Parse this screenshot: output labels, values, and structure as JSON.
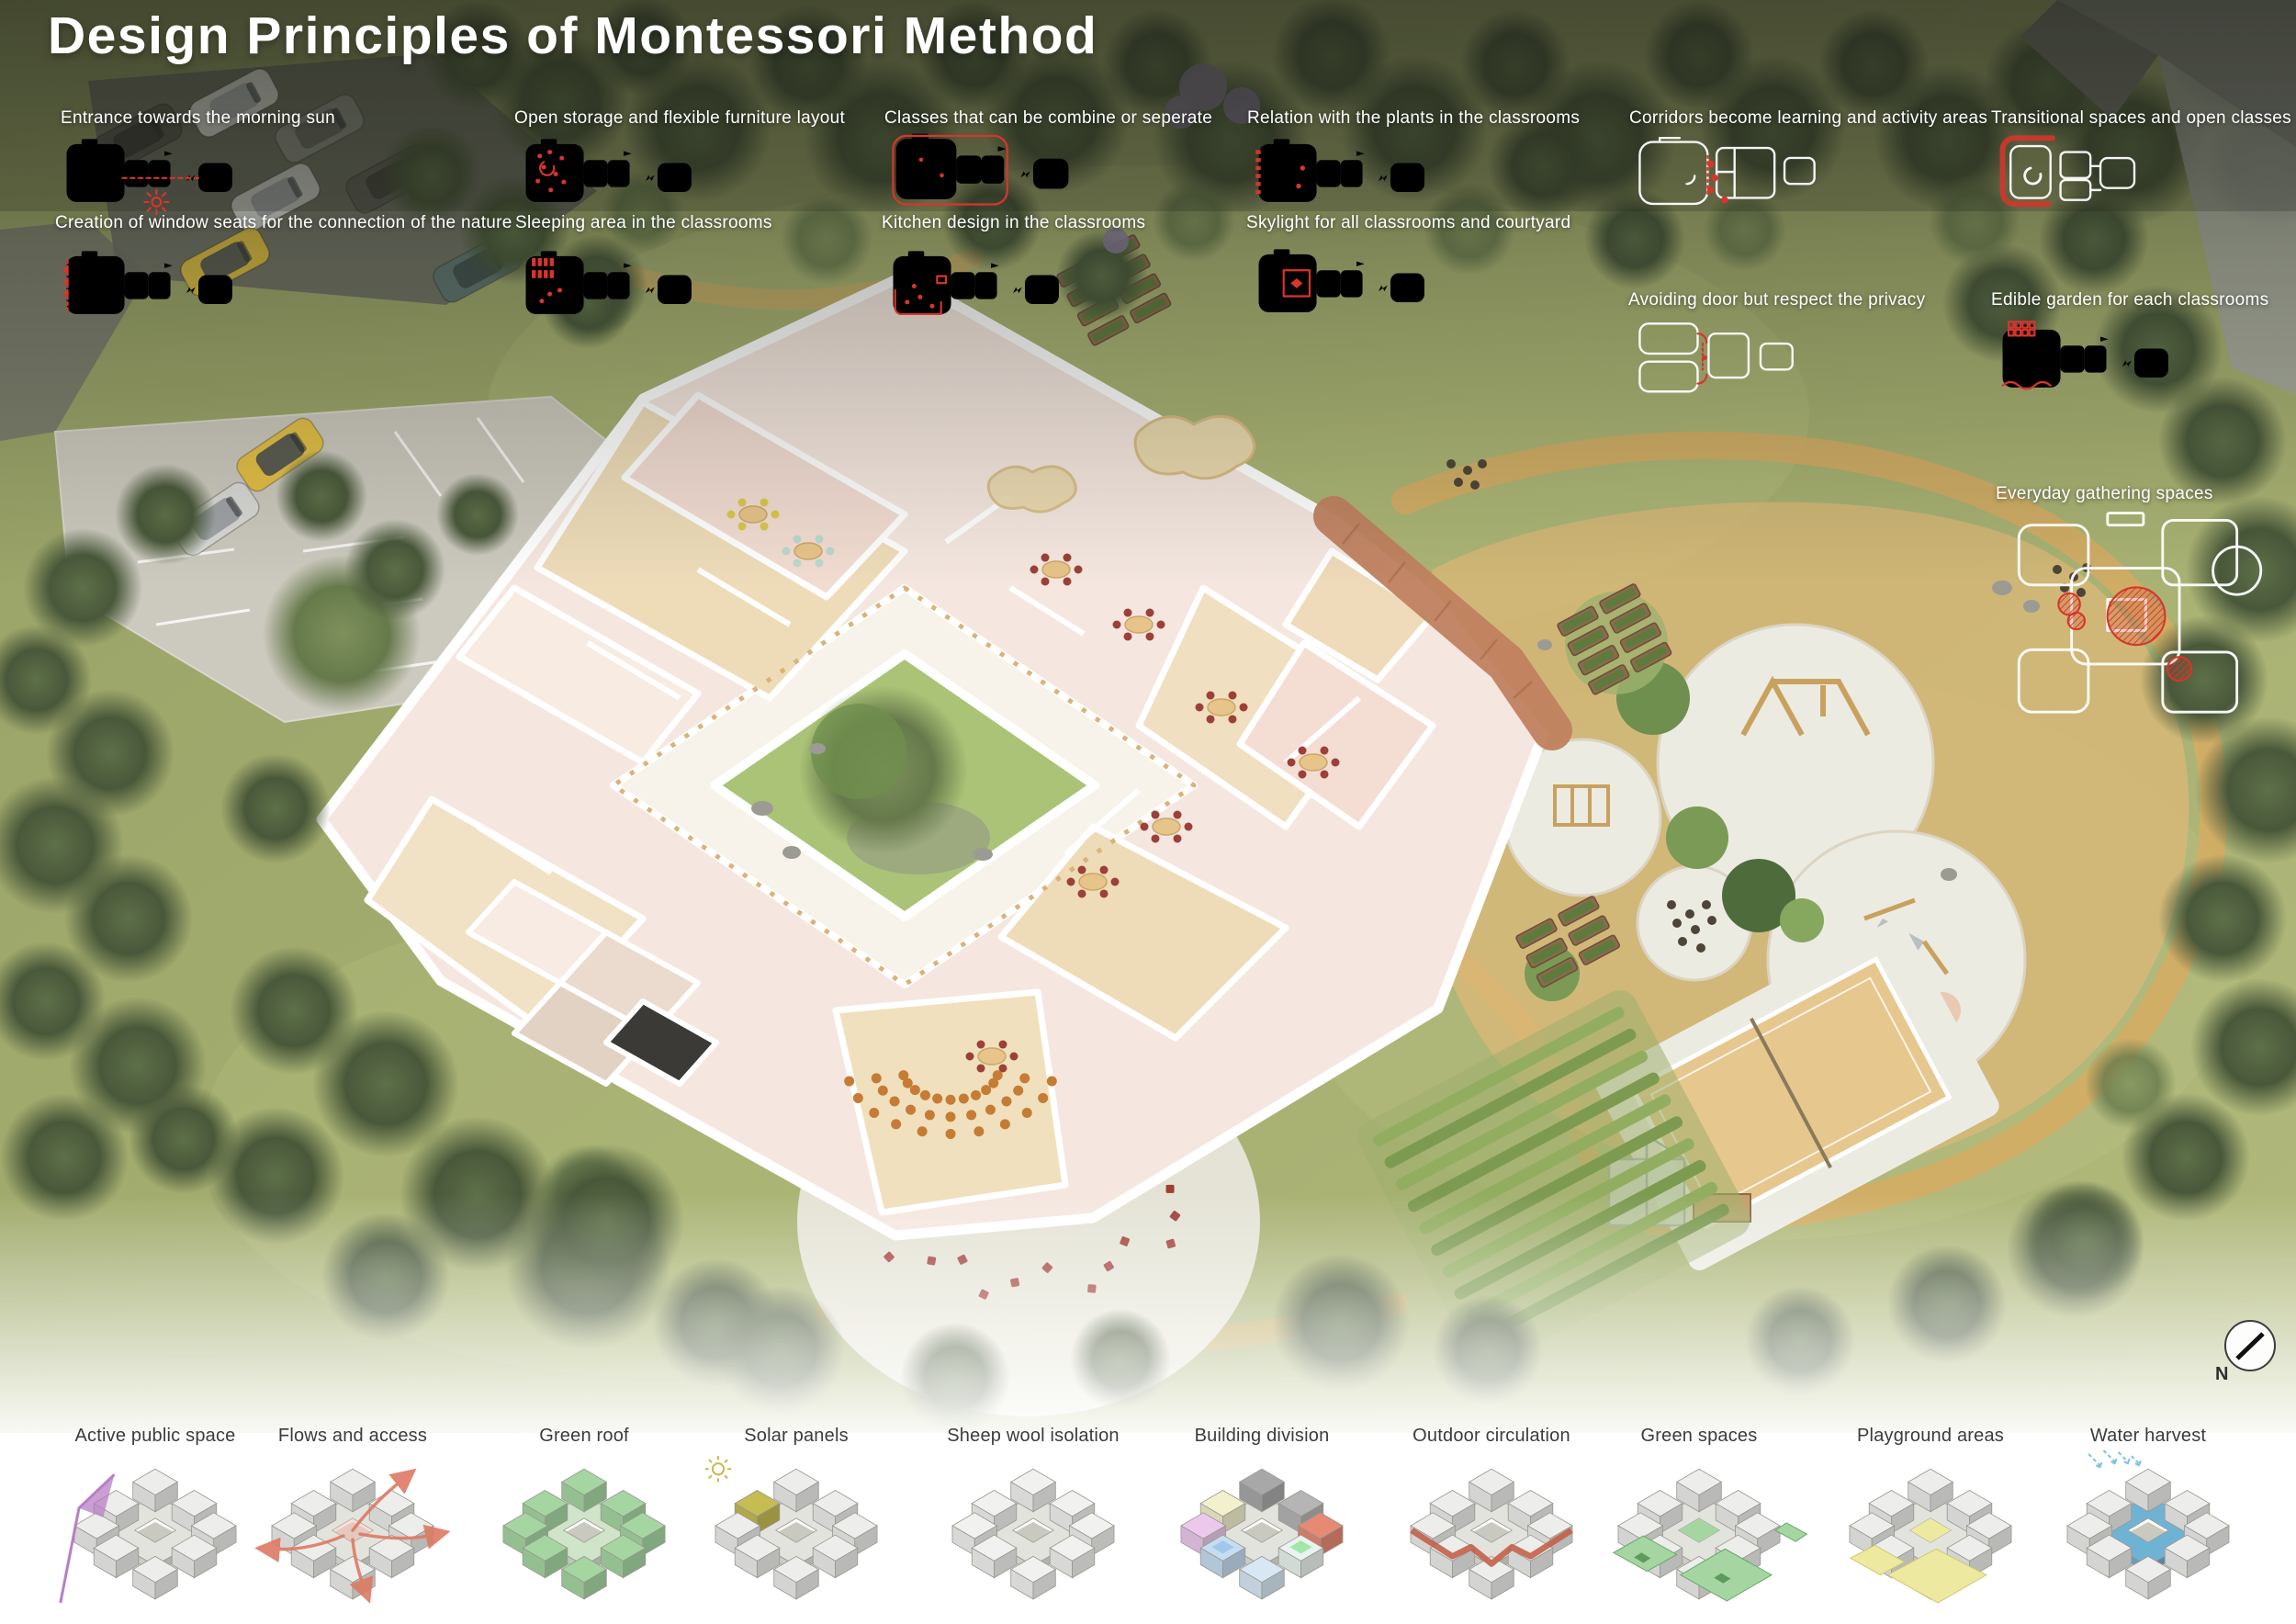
{
  "poster": {
    "title": "Design Principles of Montessori Method"
  },
  "principles": [
    {
      "label": "Entrance towards the morning sun"
    },
    {
      "label": "Creation of window seats for the connection of the nature"
    },
    {
      "label": "Open storage and flexible furniture layout"
    },
    {
      "label": "Sleeping area in the classrooms"
    },
    {
      "label": "Classes that can be combine or seperate"
    },
    {
      "label": "Kitchen design in the classrooms"
    },
    {
      "label": "Relation with the plants in the classrooms"
    },
    {
      "label": "Skylight for all classrooms and courtyard"
    },
    {
      "label": "Corridors become learning and activity areas"
    },
    {
      "label": "Avoiding door but respect the privacy"
    },
    {
      "label": "Transitional spaces and open classes"
    },
    {
      "label": "Edible garden for each classrooms"
    },
    {
      "label": "Everyday gathering spaces"
    }
  ],
  "strategies": [
    {
      "label": "Active public space",
      "accent": "#b77fc6"
    },
    {
      "label": "Flows and access",
      "accent": "#dd7a63"
    },
    {
      "label": "Green roof",
      "accent": "#a5d6a2"
    },
    {
      "label": "Solar panels",
      "accent": "#c5bc52"
    },
    {
      "label": "Sheep wool isolation",
      "accent": "#f1f1ef"
    },
    {
      "label": "Building division",
      "accent": "#d9cba9",
      "palette": [
        "#ecc9ec",
        "#f2f0cd",
        "#a8a8a8",
        "#b5b5b5",
        "#e78a74",
        "#eaf3ef",
        "#d7e8f4",
        "#c6ddf0",
        "#9fc8ec",
        "#9fe8a8"
      ]
    },
    {
      "label": "Outdoor circulation",
      "accent": "#c2604a"
    },
    {
      "label": "Green spaces",
      "accent": "#a5d6a2"
    },
    {
      "label": "Playground areas",
      "accent": "#eee9a0"
    },
    {
      "label": "Water harvest",
      "accent": "#6fb3d4"
    }
  ],
  "compass": {
    "label": "N"
  },
  "colors": {
    "plan_outline": "#ffffff",
    "plan_accent_red": "#d8352b",
    "building_pink": "#f5e7e0",
    "wood_floor": "#eedcb9",
    "courtyard_green": "#abc377",
    "path_tan": "#d6ab63",
    "canvas_white": "#ffffff"
  }
}
